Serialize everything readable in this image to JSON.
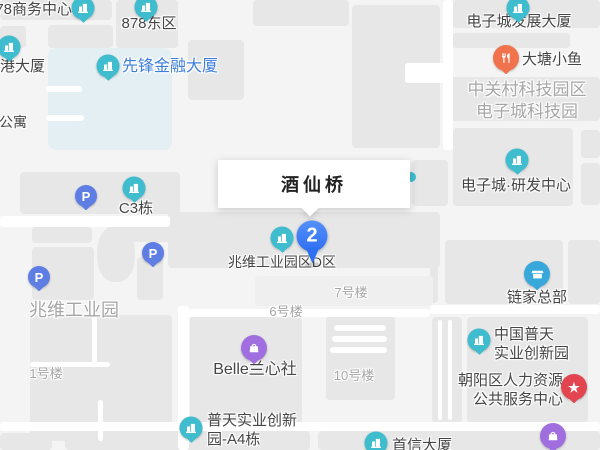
{
  "popup": {
    "title": "酒仙桥"
  },
  "marker": {
    "label": "2"
  },
  "map": {
    "colors": {
      "teal": "#3FBDCE",
      "parking": "#5F7EE3",
      "food": "#F0734D",
      "lianjia": "#38A8DB",
      "star": "#E2454F",
      "bag": "#A16EE0",
      "dot": "#3FBDCE",
      "marker_blue": "#3D7BF7",
      "highlight": "#3D7EDB",
      "label_dark": "#454545",
      "label_area": "#A6A6A6",
      "water": "#E4EFF3"
    },
    "pois": [
      {
        "id": "878-business-center",
        "type": "teal",
        "icon": "building-icon",
        "x": 83,
        "y": 8,
        "label": {
          "lines": [
            "78商务中心"
          ],
          "x": 72,
          "y": 9,
          "align": "right"
        }
      },
      {
        "id": "878-east",
        "type": "teal",
        "icon": "building-icon",
        "x": 146,
        "y": 7,
        "label": {
          "lines": [
            "878东区"
          ],
          "x": 149,
          "y": 23,
          "align": "center"
        }
      },
      {
        "id": "gang-tower",
        "type": "teal",
        "icon": "building-icon",
        "x": 9,
        "y": 47,
        "label": {
          "lines": [
            "港大厦"
          ],
          "x": 0,
          "y": 66,
          "align": "left"
        }
      },
      {
        "id": "xianfeng-finance",
        "type": "teal",
        "icon": "building-icon",
        "x": 108,
        "y": 66,
        "label": {
          "lines": [
            "先锋金融大厦"
          ],
          "x": 122,
          "y": 67,
          "align": "left",
          "color": "highlight",
          "size": 16
        }
      },
      {
        "id": "dzc-development",
        "type": "teal",
        "icon": "building-icon",
        "x": 518,
        "y": 8,
        "label": {
          "lines": [
            "电子城发展大厦"
          ],
          "x": 519,
          "y": 21,
          "align": "center"
        }
      },
      {
        "id": "datang-xiaoyu",
        "type": "food",
        "icon": "restaurant-icon",
        "x": 506,
        "y": 58,
        "label": {
          "lines": [
            "大塘小鱼"
          ],
          "x": 522,
          "y": 59,
          "align": "left"
        }
      },
      {
        "id": "dzc-rd-center",
        "type": "teal",
        "icon": "building-icon",
        "x": 517,
        "y": 160,
        "label": {
          "lines": [
            "电子城·研发中心"
          ],
          "x": 516,
          "y": 185,
          "align": "center"
        }
      },
      {
        "id": "c3-building",
        "type": "teal",
        "icon": "building-icon",
        "x": 134,
        "y": 188,
        "label": {
          "lines": [
            "C3栋"
          ],
          "x": 136,
          "y": 208,
          "align": "center"
        }
      },
      {
        "id": "zhaowei-d-zone",
        "type": "teal",
        "icon": "building-icon",
        "x": 282,
        "y": 238,
        "label": {
          "lines": [
            "兆维工业园区D区"
          ],
          "x": 282,
          "y": 262,
          "align": "center",
          "size": 14
        }
      },
      {
        "id": "lianjia-hq",
        "type": "lianjia",
        "icon": "storefront-icon",
        "x": 537,
        "y": 274,
        "label": {
          "lines": [
            "链家总部"
          ],
          "x": 537,
          "y": 297,
          "align": "center"
        }
      },
      {
        "id": "china-putian",
        "type": "teal",
        "icon": "building-icon",
        "x": 479,
        "y": 340,
        "label": {
          "lines": [
            "中国普天",
            "实业创新园"
          ],
          "x": 494,
          "y": 344,
          "align": "left"
        }
      },
      {
        "id": "chaoyang-hr-center",
        "type": "star",
        "glyph": "★",
        "x": 574,
        "y": 387,
        "label": {
          "lines": [
            "朝阳区人力资源",
            "公共服务中心"
          ],
          "x": 563,
          "y": 390,
          "align": "right"
        }
      },
      {
        "id": "belle-lanxinshe",
        "type": "bag",
        "icon": "shopping-bag-icon",
        "x": 254,
        "y": 348,
        "label": {
          "lines": [
            "Belle兰心社"
          ],
          "x": 255,
          "y": 370,
          "align": "center",
          "size": 16
        }
      },
      {
        "id": "putian-a4",
        "type": "teal",
        "icon": "building-icon",
        "x": 191,
        "y": 428,
        "label": {
          "lines": [
            "普天实业创新",
            "园-A4栋"
          ],
          "x": 207,
          "y": 430,
          "align": "left"
        }
      },
      {
        "id": "shouxin-tower",
        "type": "teal",
        "icon": "building-icon",
        "x": 376,
        "y": 443,
        "label": {
          "lines": [
            "首信大厦"
          ],
          "x": 392,
          "y": 445,
          "align": "left"
        }
      },
      {
        "id": "shop-poi-bottom",
        "type": "bag",
        "icon": "shopping-bag-icon",
        "x": 553,
        "y": 436
      },
      {
        "id": "parking-1",
        "type": "parking",
        "glyph": "P",
        "x": 86,
        "y": 196
      },
      {
        "id": "parking-2",
        "type": "parking",
        "glyph": "P",
        "x": 153,
        "y": 253
      },
      {
        "id": "parking-3",
        "type": "parking",
        "glyph": "P",
        "x": 39,
        "y": 277
      },
      {
        "id": "hidden-poi",
        "type": "dot",
        "x": 411,
        "y": 177
      }
    ],
    "area_labels": [
      {
        "id": "zgc-tech-park",
        "lines": [
          "中关村科技园区",
          "电子城科技园"
        ],
        "x": 527,
        "y": 101,
        "size": 17,
        "align": "center"
      },
      {
        "id": "zhaowei-industrial-park",
        "lines": [
          "兆维工业园"
        ],
        "x": 74,
        "y": 310,
        "size": 18,
        "align": "center"
      },
      {
        "id": "building-no1",
        "lines": [
          "1号楼"
        ],
        "x": 46,
        "y": 373,
        "size": 13,
        "align": "center"
      },
      {
        "id": "building-no6",
        "lines": [
          "6号楼"
        ],
        "x": 286,
        "y": 311,
        "size": 13,
        "align": "center"
      },
      {
        "id": "building-no7",
        "lines": [
          "7号楼"
        ],
        "x": 351,
        "y": 292,
        "size": 13,
        "align": "center"
      },
      {
        "id": "building-no10",
        "lines": [
          "10号楼"
        ],
        "x": 354,
        "y": 375,
        "size": 13,
        "align": "center"
      },
      {
        "id": "apartment",
        "lines": [
          "公寓"
        ],
        "x": 13,
        "y": 122,
        "size": 14,
        "align": "center",
        "color": "label_dark"
      }
    ]
  }
}
